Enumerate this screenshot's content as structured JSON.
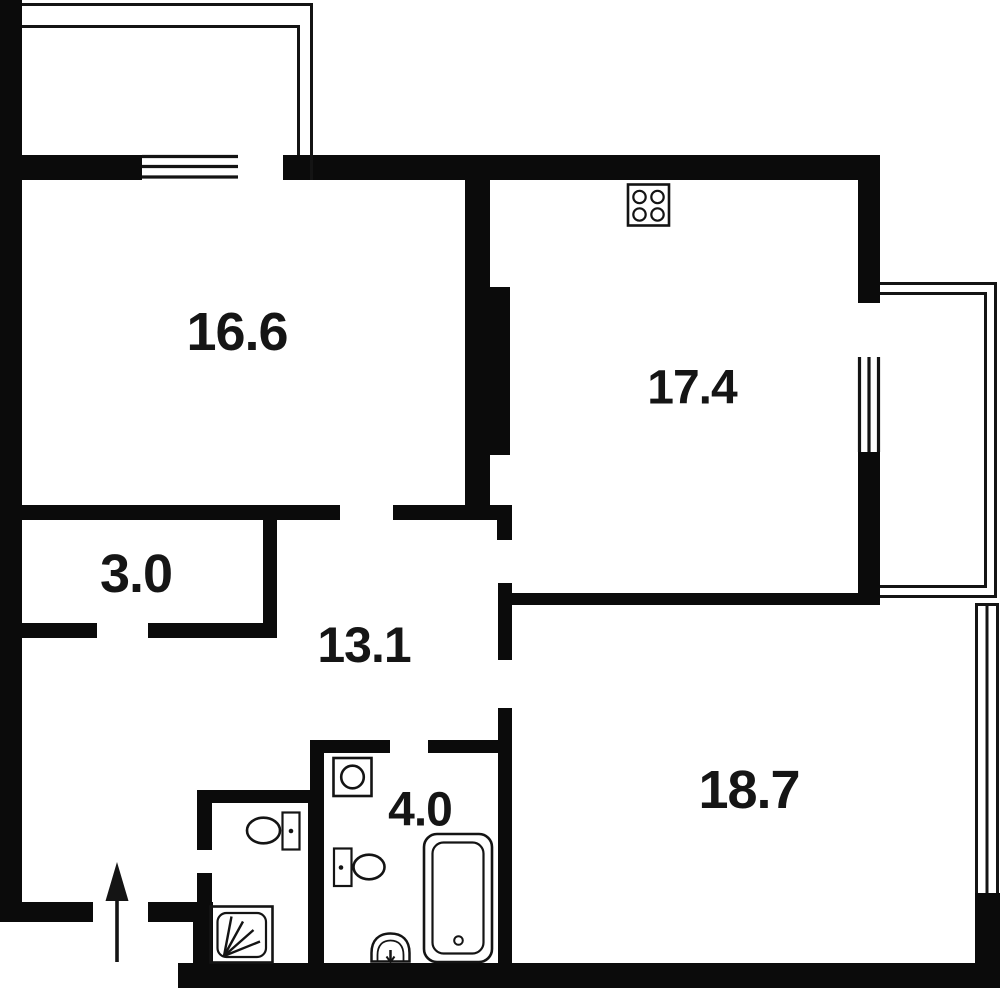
{
  "document": {
    "type": "apartment-floor-plan"
  },
  "rooms": {
    "living_room": {
      "area": "16.6"
    },
    "kitchen": {
      "area": "17.4"
    },
    "storage": {
      "area": "3.0"
    },
    "hallway": {
      "area": "13.1"
    },
    "bathroom": {
      "area": "4.0"
    },
    "bedroom": {
      "area": "18.7"
    }
  },
  "fixtures": {
    "stove": "stove-4-burner-icon",
    "washing_machine": "washing-machine-icon",
    "toilet_bathroom": "toilet-icon",
    "toilet_wc": "toilet-icon",
    "sink": "sink-icon",
    "bathtub": "bathtub-icon",
    "shower": "shower-tray-icon",
    "entrance": "entrance-arrow-icon"
  },
  "features": {
    "balcony_top": "balcony-outline",
    "balcony_right": "balcony-outline",
    "window_top": "window",
    "window_kitchen": "window",
    "window_bedroom": "window"
  },
  "colors": {
    "wall": "#0b0b0b",
    "background": "#ffffff",
    "line": "#141414"
  }
}
